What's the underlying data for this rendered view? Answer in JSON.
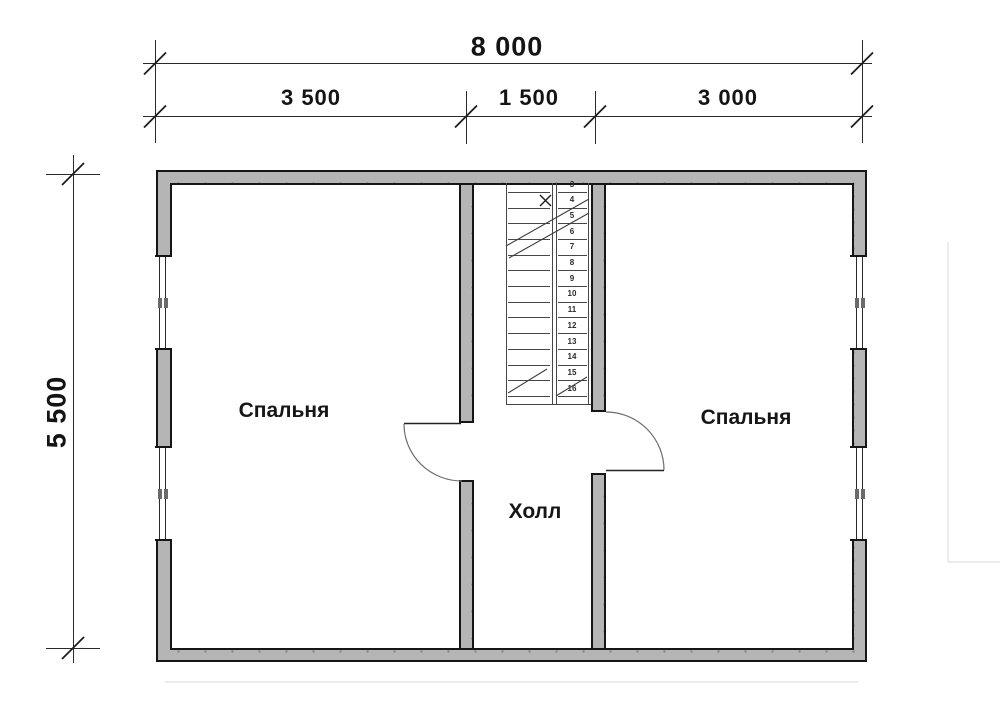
{
  "title": "Second floor plan",
  "dimensions": {
    "total_width": "8 000",
    "segments": [
      "3 500",
      "1 500",
      "3 000"
    ],
    "height": "5 500"
  },
  "rooms": {
    "bedroom_left": "Спальня",
    "bedroom_right": "Спальня",
    "hall": "Холл"
  },
  "stairs": {
    "steps": [
      "3",
      "4",
      "5",
      "6",
      "7",
      "8",
      "9",
      "10",
      "11",
      "12",
      "13",
      "14",
      "15",
      "16"
    ]
  },
  "colors": {
    "background": "#ffffff",
    "wall_fill": "#b5b5b5",
    "line": "#161616"
  }
}
